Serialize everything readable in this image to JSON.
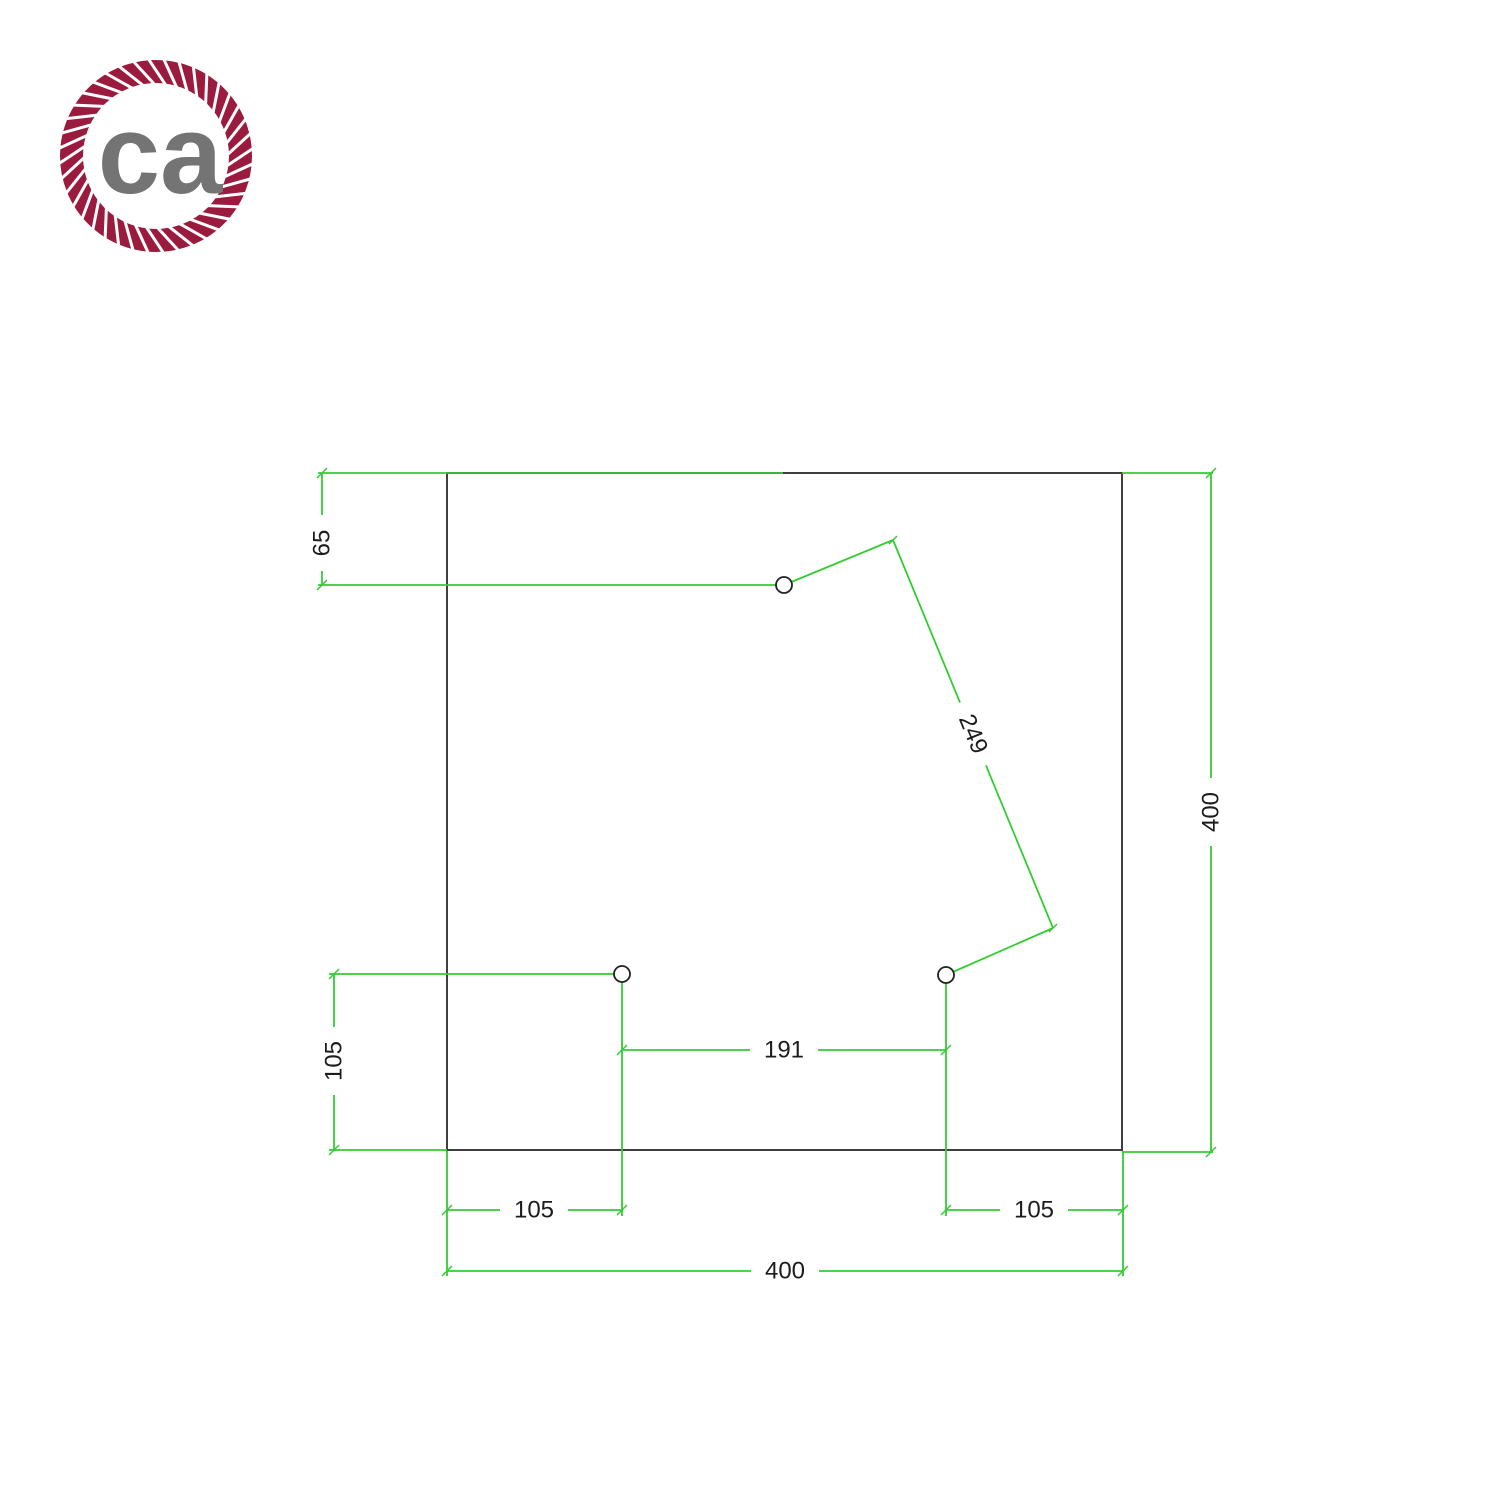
{
  "page": {
    "background": "#ffffff",
    "description": "Technical dimension drawing of a square ceiling rose plate with 3 cable holes"
  },
  "logo": {
    "text": "ca",
    "rope_color": "#9a1b3e",
    "text_color": "#747474",
    "shape": "rope-ring"
  },
  "drawing": {
    "plate_shape": "square",
    "holes_count": 3,
    "outline_color": "#3f3f3f",
    "dimension_color": "#33cc33",
    "label_color": "#1c1c1c",
    "hole_stroke_color": "#222222",
    "labels": {
      "top_hole_offset": "65",
      "diagonal_spacing": "249",
      "right_side": "400",
      "left_lower_offset": "105",
      "holes_spacing": "191",
      "bottom_left_offset": "105",
      "bottom_right_offset": "105",
      "bottom_side": "400"
    }
  }
}
